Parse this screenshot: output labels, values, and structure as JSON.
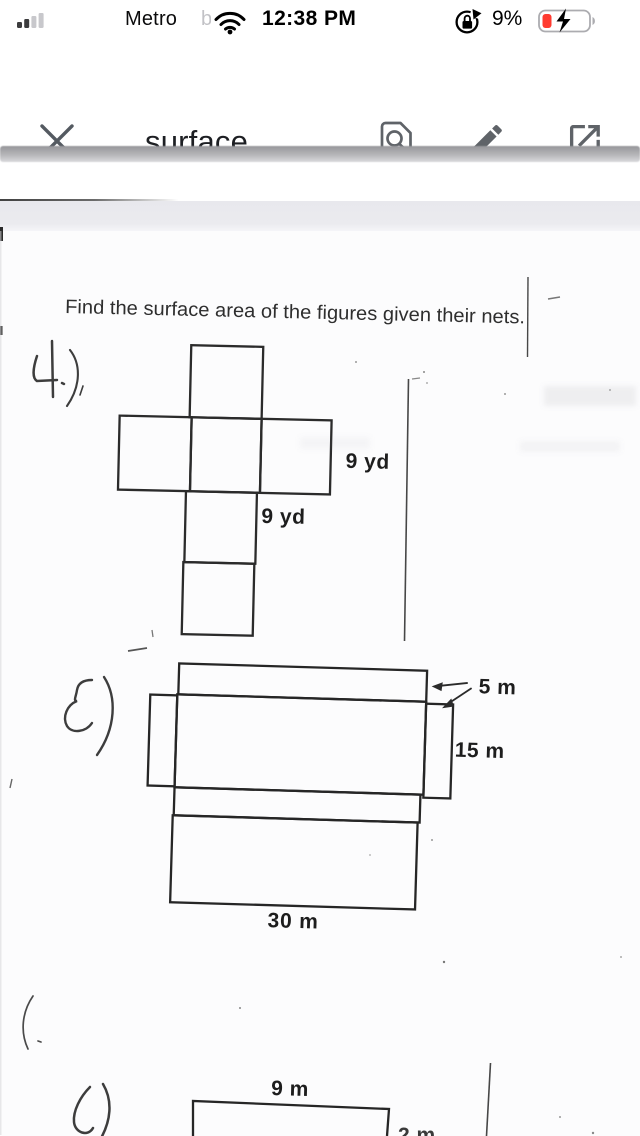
{
  "status_bar": {
    "carrier": "Metro",
    "carrier_overflow": "b",
    "time": "12:38 PM",
    "battery_percent": "9%",
    "signal_level": "2 of 4 bars"
  },
  "toolbar": {
    "title": "surface..."
  },
  "icons": {
    "close": "x-cross",
    "find_in_document": "page-with-magnifier",
    "edit": "pencil",
    "open_in": "square-with-outward-arrow",
    "wifi": "wifi-arcs",
    "cell_signal": "signal-bars",
    "orientation_lock": "lock-with-circular-arrow",
    "battery": "battery-charging-bolt"
  },
  "document": {
    "heading": "Find the surface area of the figures given their nets.",
    "problems": [
      {
        "number": "4.)",
        "figure": "cube-net-cross",
        "unit_labels": {
          "side": "9 yd",
          "bottom": "9 yd"
        }
      },
      {
        "number": "5)",
        "figure": "rectangular-prism-net",
        "unit_labels": {
          "depth": "5 m",
          "height": "15 m",
          "width": "30 m"
        }
      },
      {
        "number": "6)",
        "figure": "rectangle-partial",
        "unit_labels": {
          "top": "9 m",
          "side": "2 m"
        }
      }
    ]
  },
  "colors": {
    "toolbar_icon_gray": "#5f6368",
    "battery_red": "#ff3b30",
    "scan_ink": "#2b2b2b",
    "band_gray": "#e8e8ed"
  }
}
